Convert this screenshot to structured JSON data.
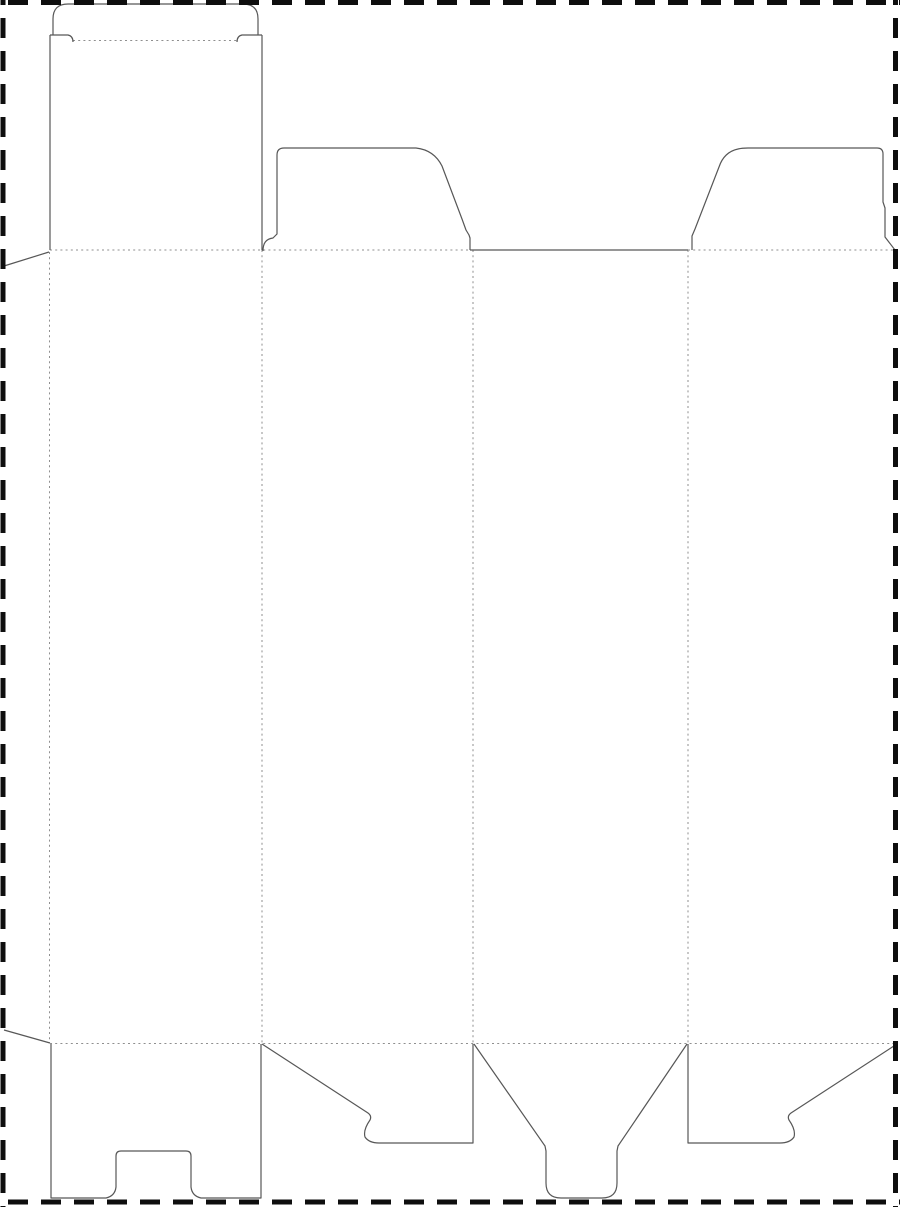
{
  "canvas": {
    "width": 900,
    "height": 1207,
    "background": "#ffffff",
    "description": "Folding carton dieline template: tuck-top box with snap-lock (1-2-3) bottom, no text labels"
  },
  "line_styles": {
    "cut": {
      "color": "#575757",
      "width": 1.2,
      "dash": ""
    },
    "fold": {
      "color": "#8f8f8f",
      "width": 1,
      "dash": "2 3.2"
    },
    "page_border": {
      "color": "#0e0e0e",
      "width": 5,
      "dash": "20 13"
    }
  },
  "page_border_lines": [
    {
      "name": "page-border-top",
      "x1": 0,
      "y1": 2.5,
      "x2": 900,
      "y2": 2.5,
      "dashoffset": 25
    },
    {
      "name": "page-border-left",
      "x1": 3,
      "y1": 0,
      "x2": 3,
      "y2": 1207,
      "dashoffset": 15
    },
    {
      "name": "page-border-right",
      "x1": 895.5,
      "y1": 0,
      "x2": 895.5,
      "y2": 1207,
      "dashoffset": 15
    },
    {
      "name": "page-border-bottom",
      "x1": 0,
      "y1": 1202,
      "x2": 900,
      "y2": 1202,
      "dashoffset": 25
    }
  ],
  "fold_lines": [
    {
      "name": "fold-tuck-flap",
      "x1": 73,
      "y1": 40.5,
      "x2": 237,
      "y2": 40.5
    },
    {
      "name": "fold-top-left-section",
      "x1": 50,
      "y1": 250,
      "x2": 470,
      "y2": 250
    },
    {
      "name": "fold-top-right-section",
      "x1": 688,
      "y1": 250,
      "x2": 895,
      "y2": 250
    },
    {
      "name": "fold-bottom",
      "x1": 50,
      "y1": 1043.5,
      "x2": 897,
      "y2": 1043.5
    },
    {
      "name": "fold-vertical-glue-flap",
      "x1": 49.5,
      "y1": 252,
      "x2": 49.5,
      "y2": 1043
    },
    {
      "name": "fold-vertical-panel-1-2",
      "x1": 262,
      "y1": 250,
      "x2": 262,
      "y2": 1043
    },
    {
      "name": "fold-vertical-panel-2-3",
      "x1": 473,
      "y1": 250,
      "x2": 473,
      "y2": 1043
    },
    {
      "name": "fold-vertical-panel-3-4",
      "x1": 688,
      "y1": 250,
      "x2": 688,
      "y2": 1043
    }
  ],
  "cut_paths": [
    {
      "name": "glue-flap-top-edge",
      "d": "M 4 266 L 49 252"
    },
    {
      "name": "glue-flap-bottom-edge",
      "d": "M 4 1030 L 50 1043"
    },
    {
      "name": "lid-panel-left-edge",
      "d": "M 50 250 L 50 35"
    },
    {
      "name": "lid-panel-right-edge",
      "d": "M 262 250 L 262 35"
    },
    {
      "name": "tuck-flap-outline",
      "d": "M 53 35 L 53 19 Q 53 4 68 4 L 243 4 Q 258 4 258 19 L 258 35"
    },
    {
      "name": "tuck-slit-left",
      "d": "M 50 35 L 68 35 Q 73 36 73 42"
    },
    {
      "name": "tuck-slit-right",
      "d": "M 262 35 L 242 35 Q 237 36 237 42"
    },
    {
      "name": "front-panel-top-edge",
      "d": "M 470 250 L 688 250"
    },
    {
      "name": "top-dust-flap-left-outline",
      "d": "M 263 251 C 263 243 266 239 273 238 L 277 234 L 277 155 Q 277 148 284 148 L 416 148 Q 434 150 442 166 L 462 219 L 466 230 L 469 235 L 470 238 L 470 250"
    },
    {
      "name": "top-dust-flap-right-outline",
      "d": "M 692 250 L 692 236 L 695 229 L 719 167 Q 724 152 738 149 Q 742 148 748 148 L 877 148 Q 883 148 883 154 L 883 202 L 885 208 L 885 237 L 895 250"
    },
    {
      "name": "bottom-notch-flap-outline",
      "d": "M 51 1044 L 51 1198 L 106 1198 Q 115 1196 116 1187 L 116 1156 Q 116 1151 121 1151 L 186 1151 Q 191 1151 191 1156 L 191 1187 Q 192 1196 201 1198 L 261 1198 L 261 1044"
    },
    {
      "name": "bottom-snaplock-flap-left-outline",
      "d": "M 262 1044 L 368 1113 Q 372 1116 370 1120 Q 363 1130 365 1137 Q 369 1143 379 1143 L 473 1143 L 473 1044"
    },
    {
      "name": "bottom-snaplock-flap-right-outline",
      "d": "M 688 1044 L 688 1143 L 780 1143 Q 790 1143 794 1137 Q 796 1130 789 1120 Q 787 1116 791 1113 L 897 1044"
    },
    {
      "name": "bottom-lock-tongue-outline",
      "d": "M 474 1044 L 545 1146 L 546 1151 L 546 1183 Q 546 1198 561 1198 L 602 1198 Q 617 1198 617 1183 L 617 1151 L 618 1146 L 687 1044"
    }
  ]
}
